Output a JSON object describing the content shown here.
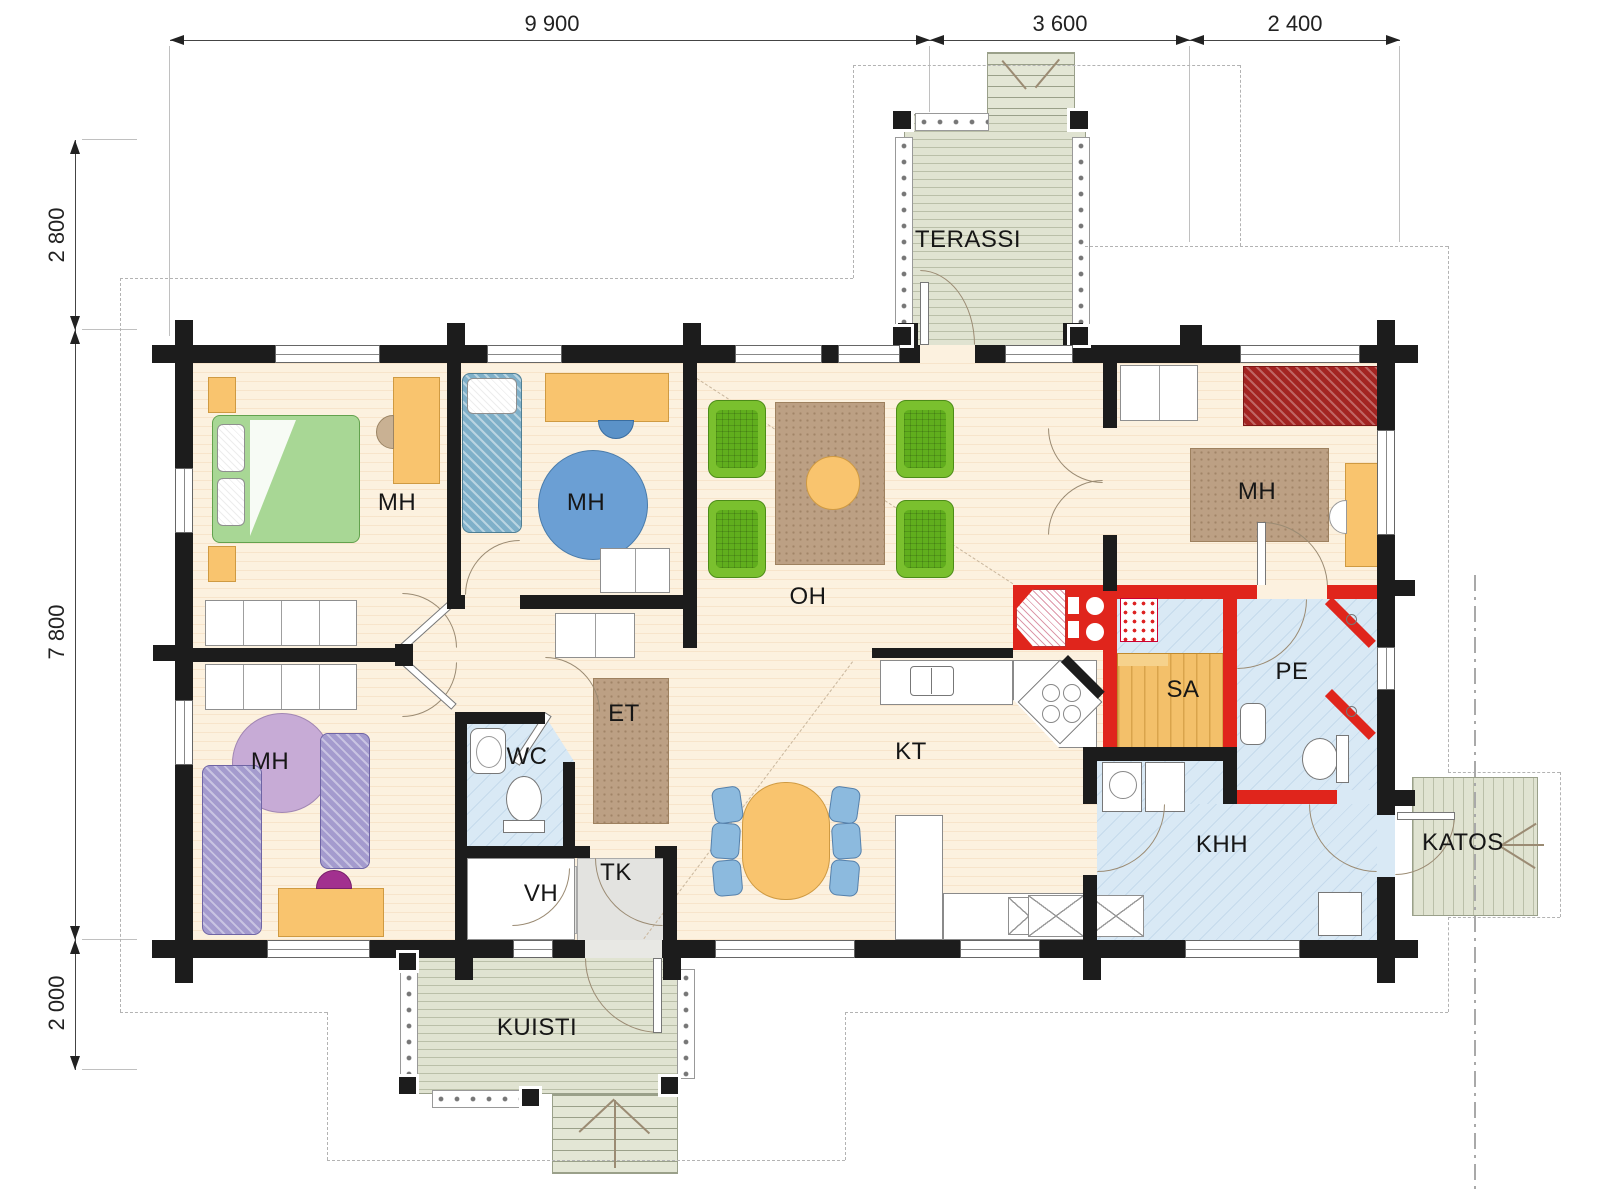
{
  "dimensions": {
    "top": [
      {
        "label": "9 900"
      },
      {
        "label": "3 600"
      },
      {
        "label": "2 400"
      }
    ],
    "left": [
      {
        "label": "2 800"
      },
      {
        "label": "7 800"
      },
      {
        "label": "2 000"
      }
    ]
  },
  "rooms": {
    "mh1": {
      "label": "MH"
    },
    "mh2": {
      "label": "MH"
    },
    "mh3": {
      "label": "MH"
    },
    "mh4": {
      "label": "MH"
    },
    "oh": {
      "label": "OH"
    },
    "kt": {
      "label": "KT"
    },
    "et": {
      "label": "ET"
    },
    "wc": {
      "label": "WC"
    },
    "vh": {
      "label": "VH"
    },
    "tk": {
      "label": "TK"
    },
    "sa": {
      "label": "SA"
    },
    "pe": {
      "label": "PE"
    },
    "khh": {
      "label": "KHH"
    },
    "terassi": {
      "label": "TERASSI"
    },
    "kuisti": {
      "label": "KUISTI"
    },
    "katos": {
      "label": "KATOS"
    }
  },
  "colors": {
    "wall": "#1c1c1c",
    "fire_wall": "#e0251c",
    "floor": "#fcf1df",
    "wet_room": "#d9e9f5",
    "deck": "#e0e3d1",
    "sauna_bench": "#f3c06a",
    "furniture_orange": "#f9c46e",
    "armchair_green": "#7ac02e",
    "bed_green": "#a8d795",
    "bed_blue": "#7fb0c9",
    "bed_purple": "#a49bce",
    "bed_dark_red": "#a32421",
    "rug_brown": "#bca084",
    "rug_purple": "#c7abd6",
    "rug_blue": "#6b9fd4",
    "dining_chair_blue": "#8cbade"
  }
}
